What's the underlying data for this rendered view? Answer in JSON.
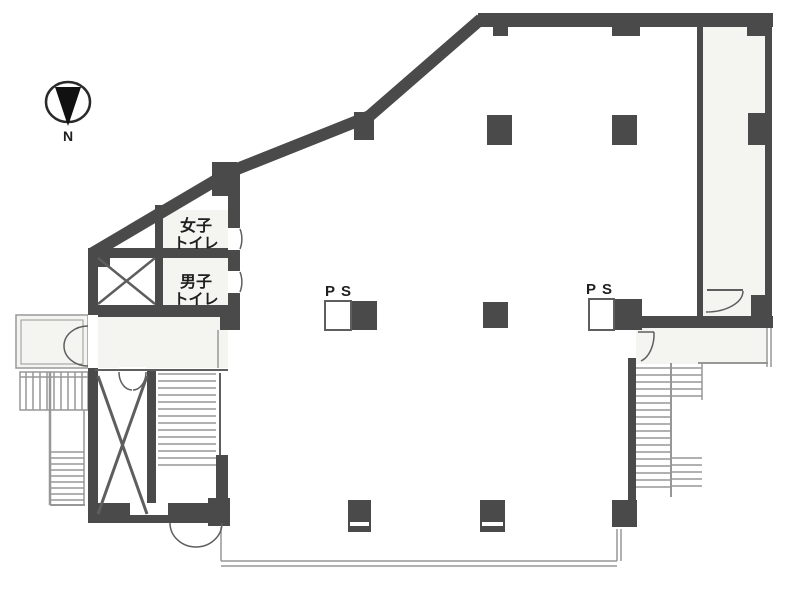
{
  "plan": {
    "kind": "office building floor plan"
  },
  "compass": {
    "north_label": "N"
  },
  "rooms": {
    "womens_toilet": {
      "label": "女子トイレ",
      "line1": "女子",
      "line2": "トイレ"
    },
    "mens_toilet": {
      "label": "男子トイレ",
      "line1": "男子",
      "line2": "トイレ"
    }
  },
  "pipe_shafts": {
    "ps_left": "PS",
    "ps_right": "PS"
  },
  "colors": {
    "wall": "#4a4a4a",
    "wall_medium": "#5e5e5e",
    "line_thin": "#979797",
    "paper": "#ffffff",
    "tint": "#f4f4f0",
    "ink": "#1f1f1f"
  }
}
